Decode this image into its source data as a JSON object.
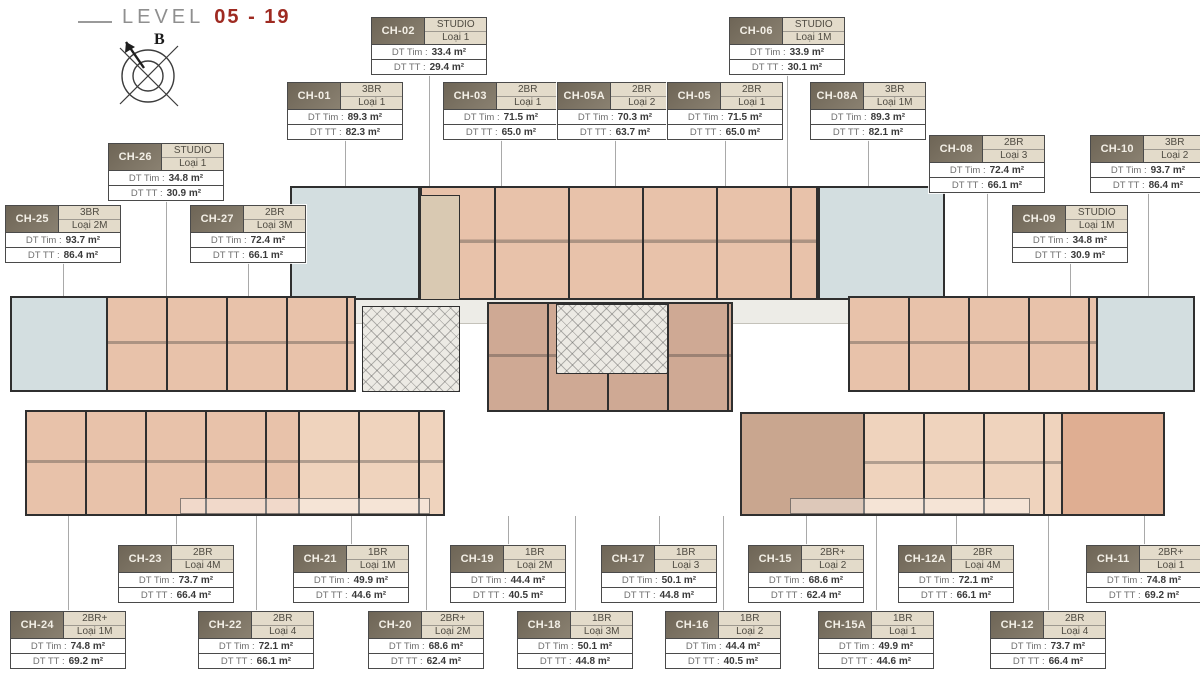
{
  "header": {
    "title_label": "LEVEL",
    "title_value": "05 - 19",
    "compass_label": "B"
  },
  "card_fields": {
    "dt_tim_label": "DT Tim :",
    "dt_tt_label": "DT TT :"
  },
  "colors": {
    "title_red": "#9e2a21",
    "card_header_bg": "#7b7263",
    "card_type_bg": "#e3dbca",
    "wall": "#2f2f2f",
    "unit_salmon": "#e8c2aa",
    "unit_blue": "#d3dee0",
    "unit_taupe": "#c9a68f",
    "corridor": "#edece7"
  },
  "units": [
    {
      "id": "CH-01",
      "type": "3BR",
      "loai": "Loại 1",
      "dt_tim": "89.3 m²",
      "dt_tt": "82.3 m²"
    },
    {
      "id": "CH-02",
      "type": "STUDIO",
      "loai": "Loại 1",
      "dt_tim": "33.4 m²",
      "dt_tt": "29.4 m²"
    },
    {
      "id": "CH-03",
      "type": "2BR",
      "loai": "Loại 1",
      "dt_tim": "71.5 m²",
      "dt_tt": "65.0 m²"
    },
    {
      "id": "CH-05A",
      "type": "2BR",
      "loai": "Loại 2",
      "dt_tim": "70.3 m²",
      "dt_tt": "63.7 m²"
    },
    {
      "id": "CH-05",
      "type": "2BR",
      "loai": "Loại 1",
      "dt_tim": "71.5 m²",
      "dt_tt": "65.0 m²"
    },
    {
      "id": "CH-06",
      "type": "STUDIO",
      "loai": "Loại 1M",
      "dt_tim": "33.9 m²",
      "dt_tt": "30.1 m²"
    },
    {
      "id": "CH-08A",
      "type": "3BR",
      "loai": "Loại 1M",
      "dt_tim": "89.3 m²",
      "dt_tt": "82.1 m²"
    },
    {
      "id": "CH-08",
      "type": "2BR",
      "loai": "Loại 3",
      "dt_tim": "72.4 m²",
      "dt_tt": "66.1 m²"
    },
    {
      "id": "CH-10",
      "type": "3BR",
      "loai": "Loại 2",
      "dt_tim": "93.7 m²",
      "dt_tt": "86.4 m²"
    },
    {
      "id": "CH-09",
      "type": "STUDIO",
      "loai": "Loại 1M",
      "dt_tim": "34.8 m²",
      "dt_tt": "30.9 m²"
    },
    {
      "id": "CH-26",
      "type": "STUDIO",
      "loai": "Loại 1",
      "dt_tim": "34.8 m²",
      "dt_tt": "30.9 m²"
    },
    {
      "id": "CH-25",
      "type": "3BR",
      "loai": "Loại 2M",
      "dt_tim": "93.7 m²",
      "dt_tt": "86.4 m²"
    },
    {
      "id": "CH-27",
      "type": "2BR",
      "loai": "Loại 3M",
      "dt_tim": "72.4 m²",
      "dt_tt": "66.1 m²"
    },
    {
      "id": "CH-23",
      "type": "2BR",
      "loai": "Loại 4M",
      "dt_tim": "73.7 m²",
      "dt_tt": "66.4 m²"
    },
    {
      "id": "CH-21",
      "type": "1BR",
      "loai": "Loại 1M",
      "dt_tim": "49.9 m²",
      "dt_tt": "44.6 m²"
    },
    {
      "id": "CH-19",
      "type": "1BR",
      "loai": "Loại 2M",
      "dt_tim": "44.4 m²",
      "dt_tt": "40.5 m²"
    },
    {
      "id": "CH-17",
      "type": "1BR",
      "loai": "Loại 3",
      "dt_tim": "50.1 m²",
      "dt_tt": "44.8 m²"
    },
    {
      "id": "CH-15",
      "type": "2BR+",
      "loai": "Loại 2",
      "dt_tim": "68.6 m²",
      "dt_tt": "62.4 m²"
    },
    {
      "id": "CH-12A",
      "type": "2BR",
      "loai": "Loại 4M",
      "dt_tim": "72.1 m²",
      "dt_tt": "66.1 m²"
    },
    {
      "id": "CH-11",
      "type": "2BR+",
      "loai": "Loại 1",
      "dt_tim": "74.8 m²",
      "dt_tt": "69.2 m²"
    },
    {
      "id": "CH-24",
      "type": "2BR+",
      "loai": "Loại 1M",
      "dt_tim": "74.8 m²",
      "dt_tt": "69.2 m²"
    },
    {
      "id": "CH-22",
      "type": "2BR",
      "loai": "Loại 4",
      "dt_tim": "72.1 m²",
      "dt_tt": "66.1 m²"
    },
    {
      "id": "CH-20",
      "type": "2BR+",
      "loai": "Loại 2M",
      "dt_tim": "68.6 m²",
      "dt_tt": "62.4 m²"
    },
    {
      "id": "CH-18",
      "type": "1BR",
      "loai": "Loại 3M",
      "dt_tim": "50.1 m²",
      "dt_tt": "44.8 m²"
    },
    {
      "id": "CH-16",
      "type": "1BR",
      "loai": "Loại 2",
      "dt_tim": "44.4 m²",
      "dt_tt": "40.5 m²"
    },
    {
      "id": "CH-15A",
      "type": "1BR",
      "loai": "Loại 1",
      "dt_tim": "49.9 m²",
      "dt_tt": "44.6 m²"
    },
    {
      "id": "CH-12",
      "type": "2BR",
      "loai": "Loại 4",
      "dt_tim": "73.7 m²",
      "dt_tt": "66.4 m²"
    }
  ]
}
